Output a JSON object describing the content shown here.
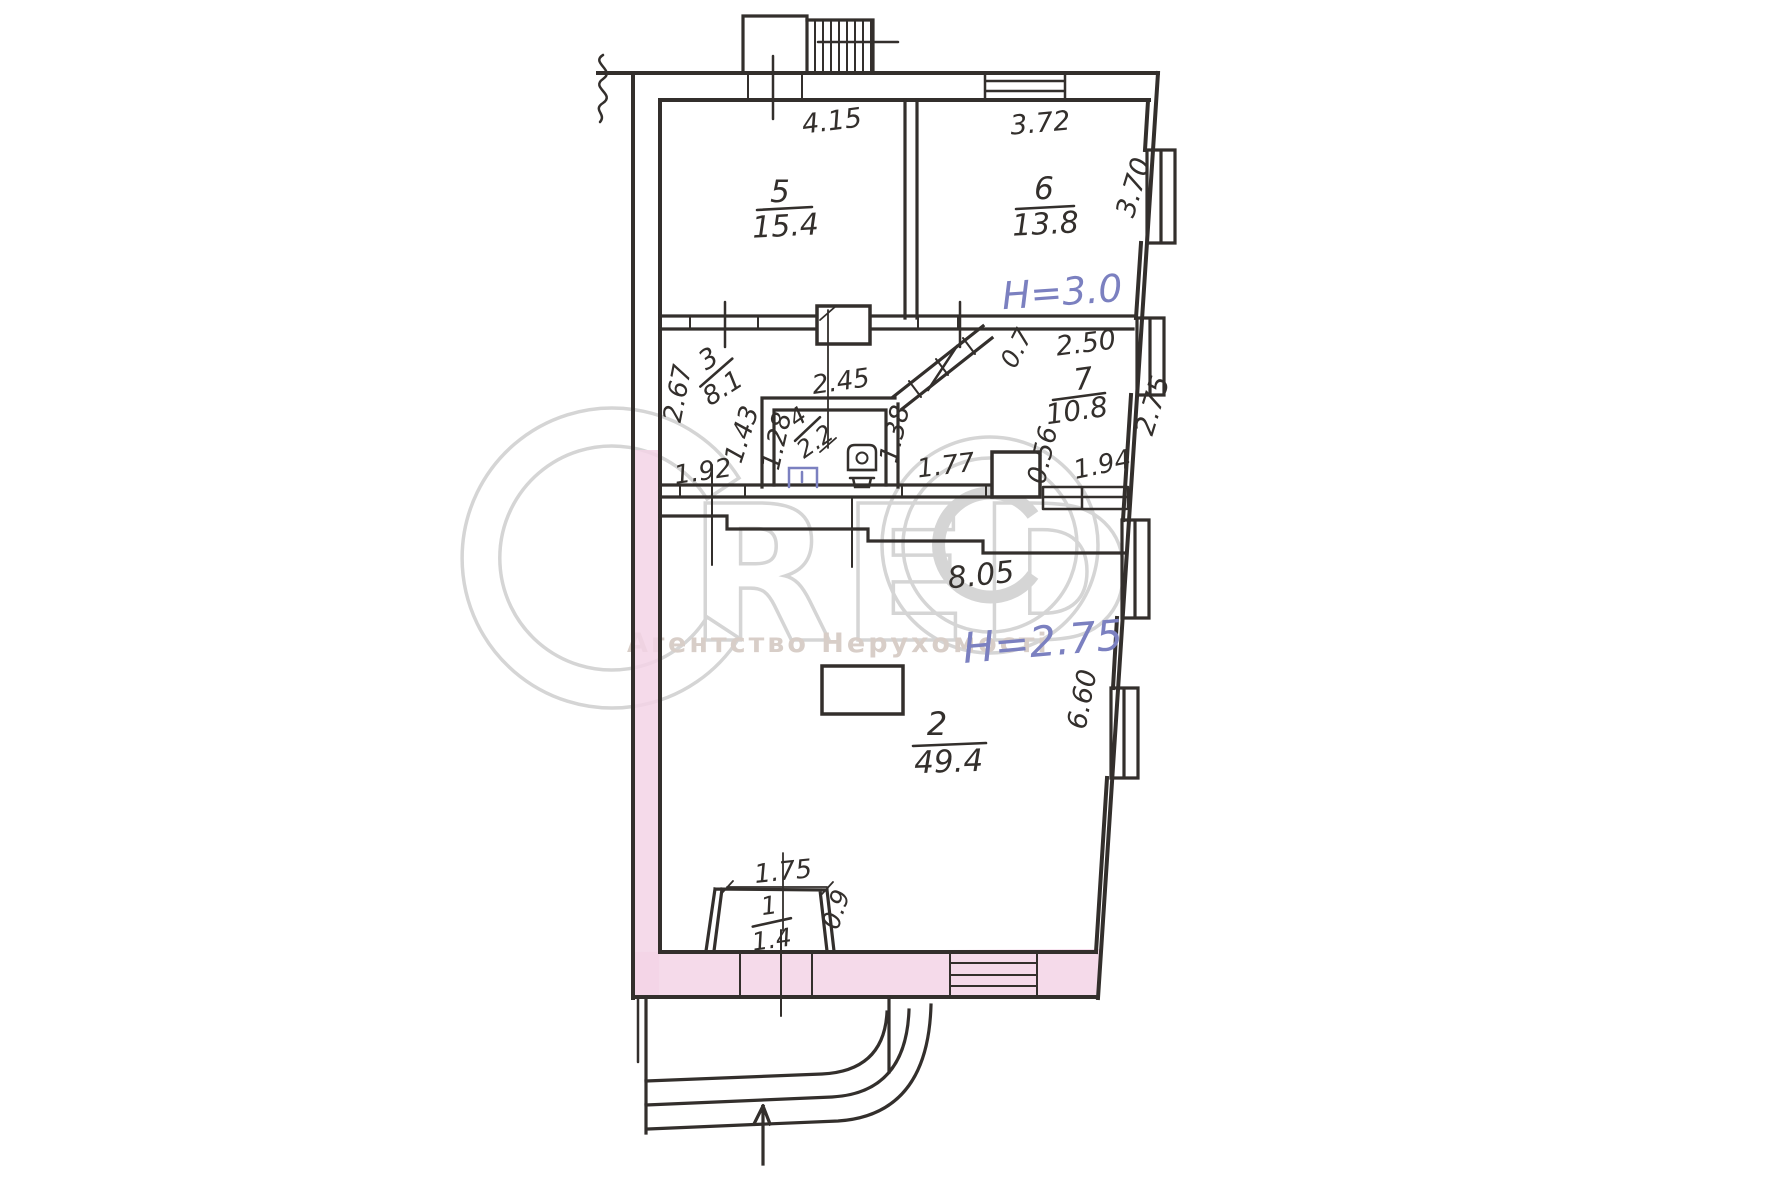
{
  "watermark": {
    "brand": "CRED©",
    "brand_red": "RED",
    "tagline": "Агентство Нерухомості"
  },
  "heights": {
    "room6": "H=3.0",
    "room2": "H=2.75"
  },
  "rooms": [
    {
      "number": "5",
      "area": "15.4"
    },
    {
      "number": "6",
      "area": "13.8"
    },
    {
      "number": "3",
      "area": "8.1"
    },
    {
      "number": "4",
      "area": "2.2"
    },
    {
      "number": "7",
      "area": "10.8"
    },
    {
      "number": "2",
      "area": "49.4"
    },
    {
      "number": "1",
      "area": "1.4"
    }
  ],
  "dimensions": {
    "room5_width": "4.15",
    "room6_width": "3.72",
    "room6_depth": "3.70",
    "room7_width": "2.50",
    "room7_depth": "2.75",
    "diag_wall": "0.7",
    "hall_depth": "2.67",
    "wc_width": "2.45",
    "wc_left": "1.43",
    "wc_inner": "1.28",
    "wc_right": "1.38",
    "hall_door": "1.92",
    "passage": "1.77",
    "pier": "0.56",
    "window_right": "1.94",
    "room2_width": "8.05",
    "room2_depth": "6.60",
    "vestibule_width": "1.75",
    "vestibule_side": "0.9"
  },
  "colors": {
    "ink": "#332f2c",
    "highlight": "#f3d4e6",
    "blue": "#7b80c0",
    "wm": "#d5d5d5",
    "tag": "#d8cec8"
  }
}
